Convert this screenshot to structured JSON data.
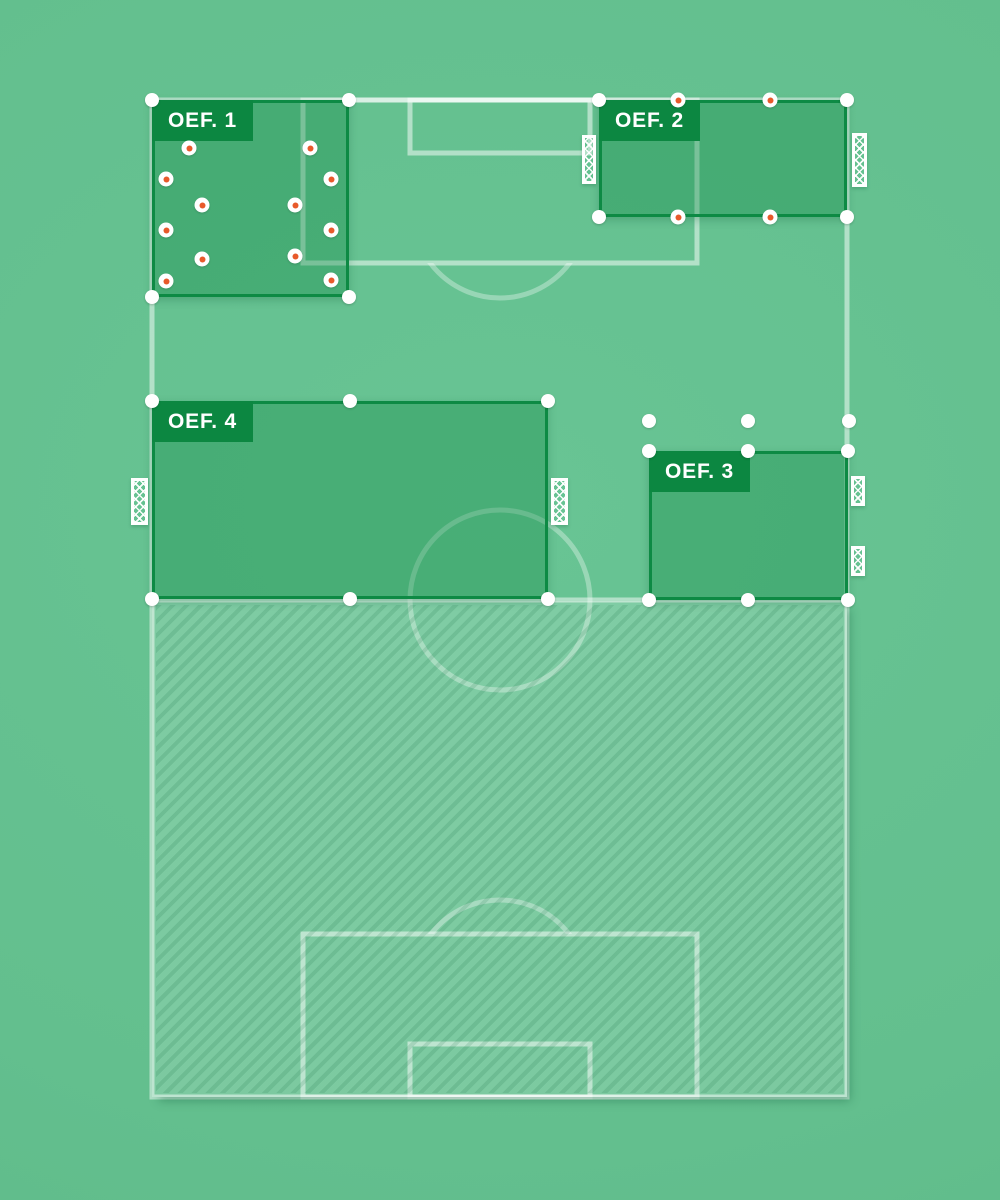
{
  "app": {
    "description": "Training session planner pitch canvas"
  },
  "colors": {
    "background": "#64c090",
    "pitch_line": "#ffffff",
    "zone_fill": "rgba(13,135,66,0.35)",
    "zone_border": "#0d8a44",
    "badge_background": "#0c8741",
    "badge_text": "#ffffff",
    "handle": "#ffffff",
    "cone_center": "#e85a2b",
    "goal": "#ffffff"
  },
  "pitch": {
    "x": 152,
    "y": 100,
    "width": 695,
    "height": 997,
    "halfway_y": 600,
    "center_circle": {
      "cx": 500,
      "cy": 600,
      "r": 90
    }
  },
  "zones": [
    {
      "id": "oef-1",
      "label": "OEF. 1",
      "x": 152,
      "y": 100,
      "w": 197,
      "h": 197,
      "handles": [
        [
          152,
          100
        ],
        [
          349,
          100
        ],
        [
          152,
          297
        ],
        [
          349,
          297
        ]
      ]
    },
    {
      "id": "oef-2",
      "label": "OEF. 2",
      "x": 599,
      "y": 100,
      "w": 248,
      "h": 117,
      "handles": [
        [
          599,
          100
        ],
        [
          847,
          100
        ],
        [
          599,
          217
        ],
        [
          847,
          217
        ]
      ]
    },
    {
      "id": "oef-3",
      "label": "OEF. 3",
      "x": 649,
      "y": 451,
      "w": 199,
      "h": 149,
      "handles": [
        [
          649,
          451
        ],
        [
          748,
          451
        ],
        [
          848,
          451
        ],
        [
          649,
          600
        ],
        [
          748,
          600
        ],
        [
          848,
          600
        ]
      ]
    },
    {
      "id": "oef-4",
      "label": "OEF. 4",
      "x": 152,
      "y": 401,
      "w": 396,
      "h": 198,
      "handles": [
        [
          152,
          401
        ],
        [
          350,
          401
        ],
        [
          548,
          401
        ],
        [
          152,
          599
        ],
        [
          350,
          599
        ],
        [
          548,
          599
        ]
      ]
    }
  ],
  "cones": [
    [
      189,
      148
    ],
    [
      310,
      148
    ],
    [
      166,
      179
    ],
    [
      331,
      179
    ],
    [
      202,
      205
    ],
    [
      295,
      205
    ],
    [
      166,
      230
    ],
    [
      331,
      230
    ],
    [
      202,
      259
    ],
    [
      295,
      256
    ],
    [
      166,
      281
    ],
    [
      331,
      280
    ],
    [
      678,
      100
    ],
    [
      770,
      100
    ],
    [
      678,
      217
    ],
    [
      770,
      217
    ]
  ],
  "floating_dots": [
    [
      649,
      421
    ],
    [
      748,
      421
    ],
    [
      849,
      421
    ]
  ],
  "goals": [
    {
      "x": 582,
      "y": 135,
      "w": 14,
      "h": 49,
      "size": "large"
    },
    {
      "x": 852,
      "y": 133,
      "w": 15,
      "h": 54,
      "size": "large"
    },
    {
      "x": 131,
      "y": 478,
      "w": 17,
      "h": 47,
      "size": "large"
    },
    {
      "x": 551,
      "y": 478,
      "w": 17,
      "h": 47,
      "size": "large"
    },
    {
      "x": 851,
      "y": 476,
      "w": 14,
      "h": 30,
      "size": "small"
    },
    {
      "x": 851,
      "y": 546,
      "w": 14,
      "h": 30,
      "size": "small"
    }
  ]
}
